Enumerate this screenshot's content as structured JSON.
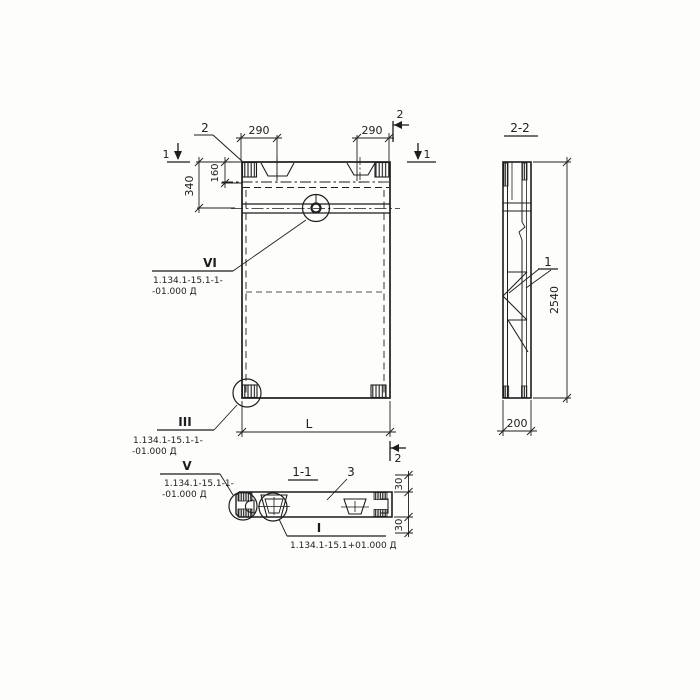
{
  "titles": {
    "section_11": "1-1",
    "section_22": "2-2"
  },
  "dimensions": {
    "top_left_290": "290",
    "top_right_290": "290",
    "left_340": "340",
    "left_160": "160",
    "length_L": "L",
    "height_2540": "2540",
    "width_200": "200",
    "plan_30_top": "30",
    "plan_30_bottom": "30"
  },
  "section_marks": {
    "cut1_left": "1",
    "cut1_right": "1",
    "cut2_top": "2",
    "cut2_bottom": "2"
  },
  "callouts": {
    "plate_2": "2",
    "part_1": "1",
    "part_3": "3",
    "vi": {
      "numeral": "VI",
      "doc_line1": "1.134.1-15.1-1-",
      "doc_line2": "-01.000 Д"
    },
    "iii": {
      "numeral": "III",
      "doc_line1": "1.134.1-15.1-1-",
      "doc_line2": "-01.000 Д"
    },
    "v": {
      "numeral": "V",
      "doc_line1": "1.134.1-15.1-1-",
      "doc_line2": "-01.000 Д"
    },
    "i": {
      "numeral": "I",
      "doc_line1": "1.134.1-15.1+01.000 Д"
    }
  },
  "colors": {
    "ink": "#1d1d1d",
    "paper": "#fdfdfc"
  }
}
